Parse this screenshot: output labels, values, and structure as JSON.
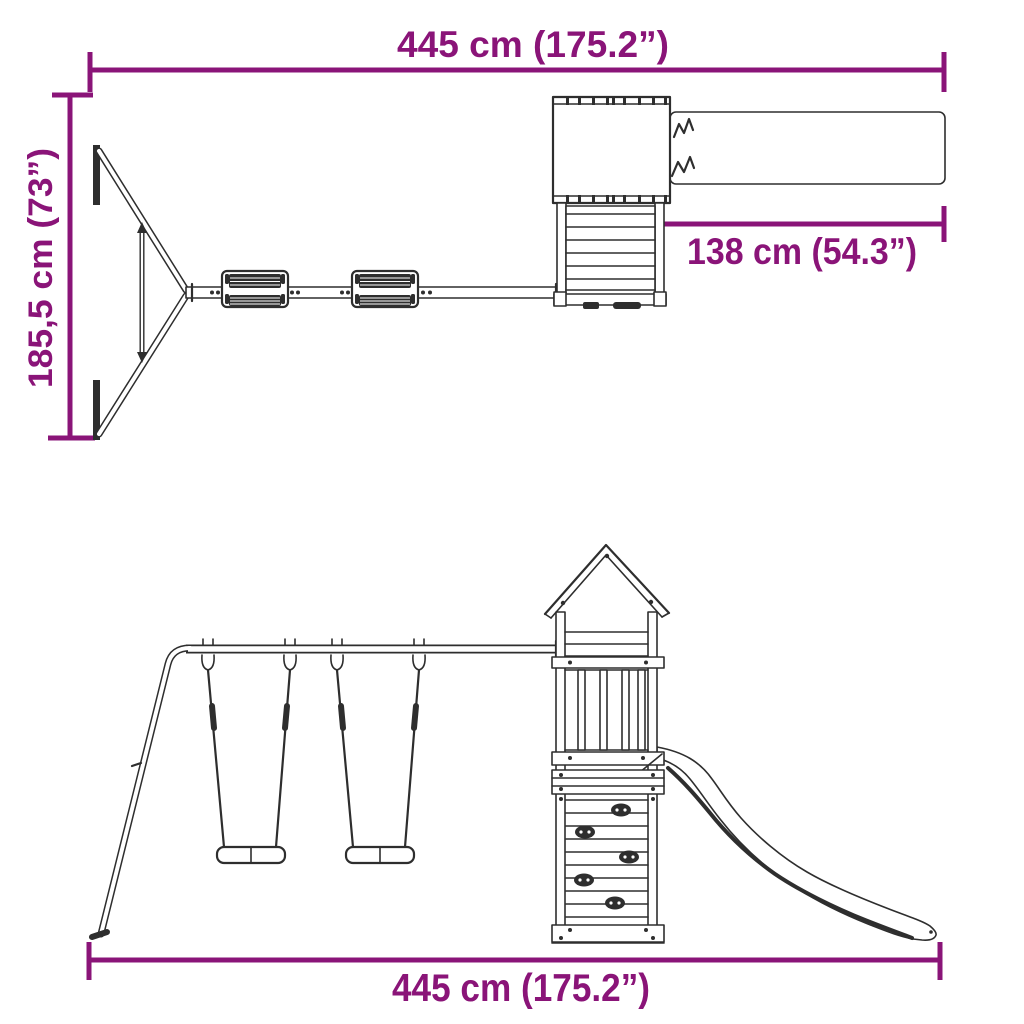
{
  "colors": {
    "accent": "#8A1478",
    "line": "#2E2E2E",
    "background": "#FFFFFF"
  },
  "dimensions": {
    "width_top": "445 cm (175.2”)",
    "height_left": "185,5 cm (73”)",
    "slide_depth": "138 cm (54.3”)",
    "width_bottom": "445 cm (175.2”)"
  }
}
